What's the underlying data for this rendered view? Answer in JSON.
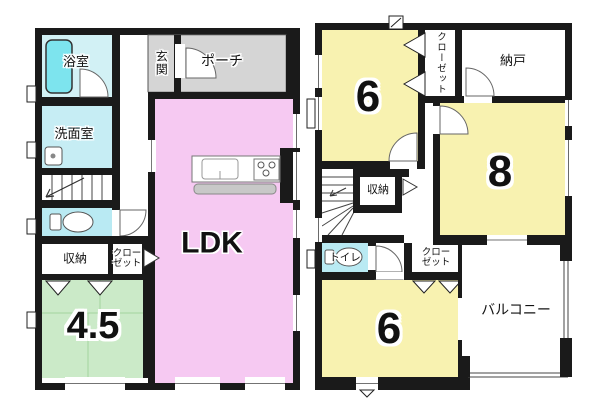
{
  "colors": {
    "wall": "#1a1a1a",
    "ldk_pink": "#f6c9f2",
    "tatami_green": "#cbeac8",
    "room_yellow": "#f8f2b0",
    "bath_cyan": "#d2f1f5",
    "washroom_cyan": "#c6edf4",
    "toilet_cyan": "#b9eaf3",
    "bathtub_cyan": "#7de4ee",
    "entrance_gray": "#d5d5d5",
    "counter_gray": "#c8c8c8"
  },
  "floor1": {
    "rooms": {
      "bath": "浴室",
      "washroom": "洗面室",
      "entrance": "玄関",
      "porch": "ポーチ",
      "ldk": "LDK",
      "storage": "収納",
      "closet": "クローゼット",
      "tatami_size": "4.5"
    }
  },
  "floor2": {
    "rooms": {
      "room6_top": "6",
      "closet_top": "クローゼット",
      "storeroom": "納戸",
      "room8": "8",
      "storage": "収納",
      "toilet": "トイレ",
      "closet_bottom": "クローゼット",
      "room6_bottom": "6",
      "balcony": "バルコニー"
    }
  }
}
